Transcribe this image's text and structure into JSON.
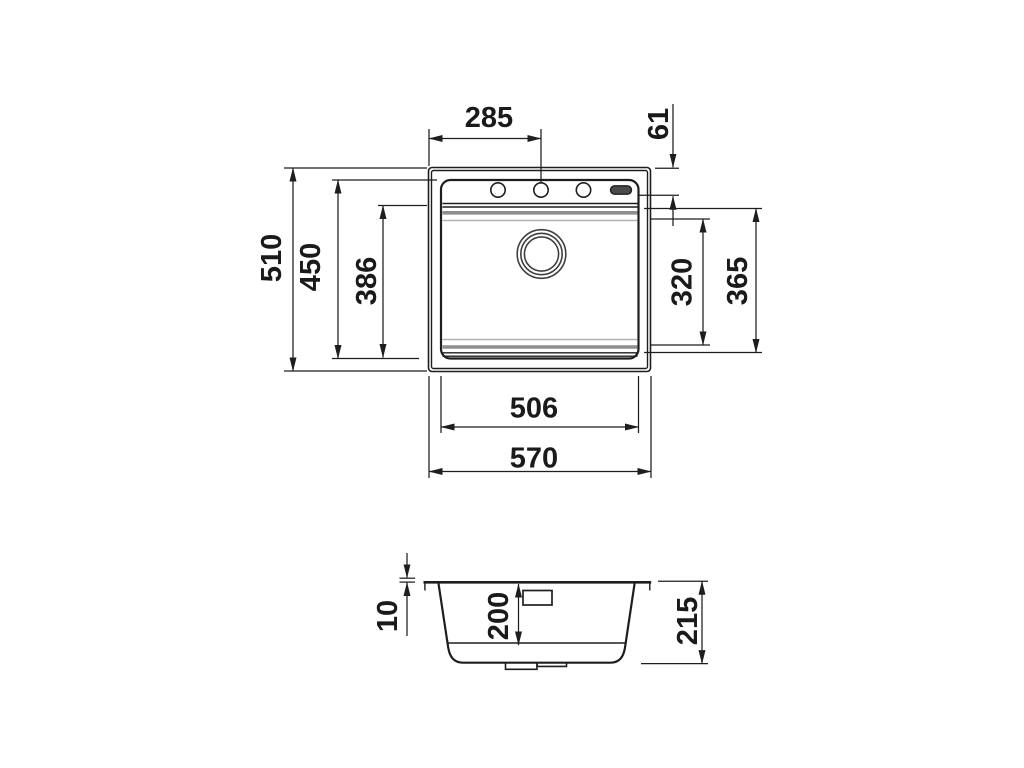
{
  "colors": {
    "line": "#1e1e1e",
    "soft_gray": "#8e8e8e",
    "light_gray": "#b3b3b3",
    "slot_fill": "#4a4a4a",
    "background": "#ffffff"
  },
  "top_view": {
    "tap_hole_offset": "285",
    "tap_hole_edge_distance": "61",
    "overall_front_to_back": "510",
    "cutout_front_to_back": "450",
    "bowl_front_to_back": "386",
    "bowl_inner_span": "320",
    "bowl_outer_span": "365",
    "cutout_width": "506",
    "overall_width": "570"
  },
  "section_view": {
    "rim_thickness": "10",
    "bowl_depth": "200",
    "overall_height": "215"
  }
}
